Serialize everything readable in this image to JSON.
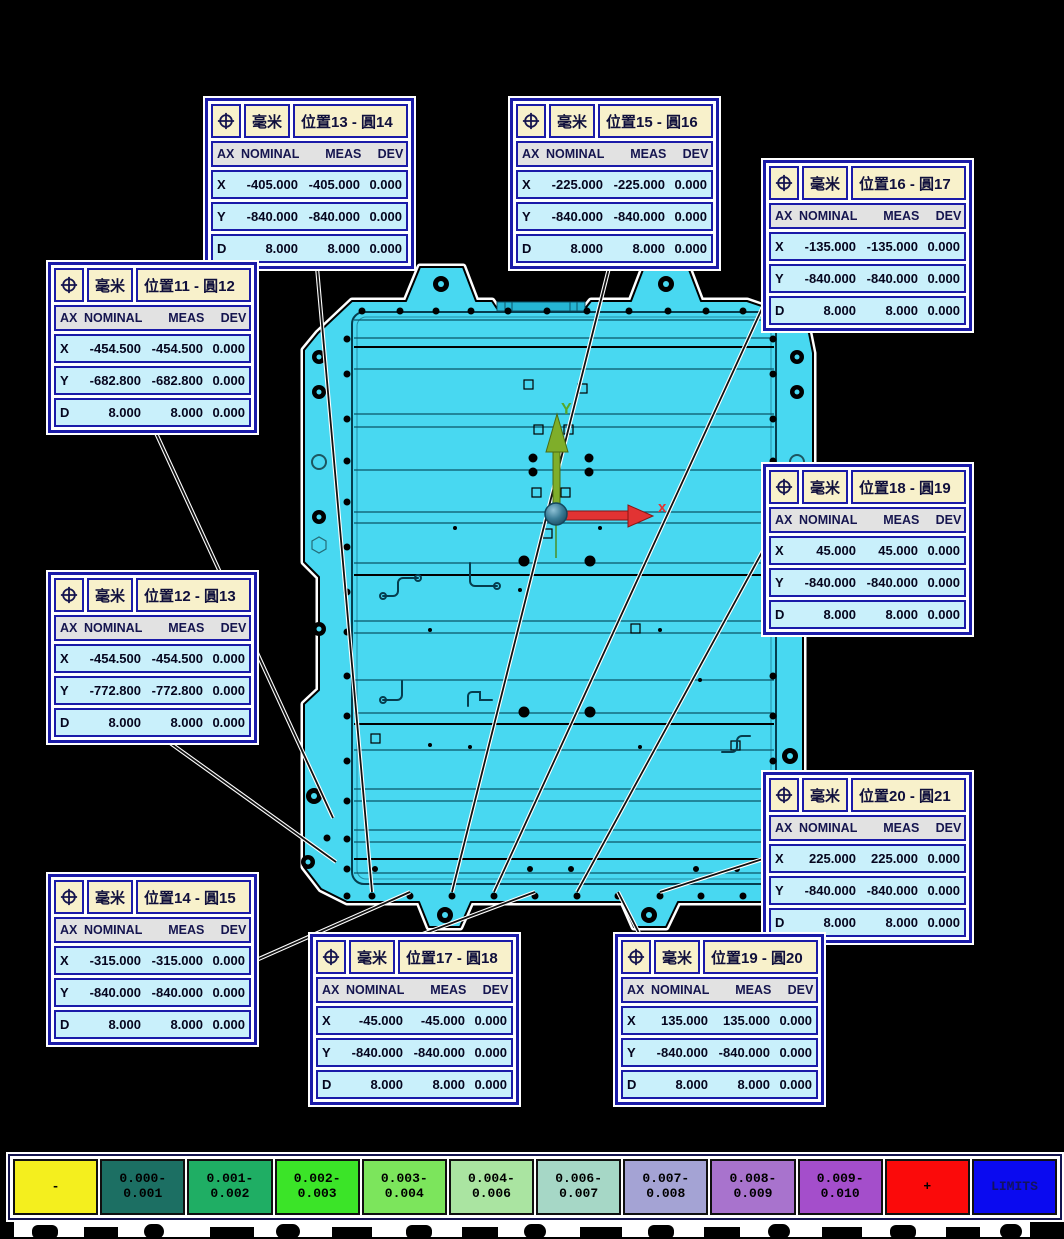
{
  "app": {
    "background": "#000000"
  },
  "colors": {
    "part_fill": "#48D8F1",
    "part_outline": "#000000",
    "box_border": "#1A1AA8",
    "box_header_bg": "#F8F1CB",
    "box_row_bg": "#C9F0FB",
    "axis_x_color": "#E23333",
    "axis_y_color": "#7FAE2A"
  },
  "axes": {
    "x_label": "x",
    "y_label": "Y"
  },
  "boxes": [
    {
      "unit": "毫米",
      "title": "位置13 - 圓14",
      "columns": [
        "AX",
        "NOMINAL",
        "MEAS",
        "DEV"
      ],
      "rows": [
        [
          "X",
          "-405.000",
          "-405.000",
          "0.000"
        ],
        [
          "Y",
          "-840.000",
          "-840.000",
          "0.000"
        ],
        [
          "D",
          "8.000",
          "8.000",
          "0.000"
        ]
      ]
    },
    {
      "unit": "毫米",
      "title": "位置15 - 圓16",
      "columns": [
        "AX",
        "NOMINAL",
        "MEAS",
        "DEV"
      ],
      "rows": [
        [
          "X",
          "-225.000",
          "-225.000",
          "0.000"
        ],
        [
          "Y",
          "-840.000",
          "-840.000",
          "0.000"
        ],
        [
          "D",
          "8.000",
          "8.000",
          "0.000"
        ]
      ]
    },
    {
      "unit": "毫米",
      "title": "位置16 - 圓17",
      "columns": [
        "AX",
        "NOMINAL",
        "MEAS",
        "DEV"
      ],
      "rows": [
        [
          "X",
          "-135.000",
          "-135.000",
          "0.000"
        ],
        [
          "Y",
          "-840.000",
          "-840.000",
          "0.000"
        ],
        [
          "D",
          "8.000",
          "8.000",
          "0.000"
        ]
      ]
    },
    {
      "unit": "毫米",
      "title": "位置11 - 圓12",
      "columns": [
        "AX",
        "NOMINAL",
        "MEAS",
        "DEV"
      ],
      "rows": [
        [
          "X",
          "-454.500",
          "-454.500",
          "0.000"
        ],
        [
          "Y",
          "-682.800",
          "-682.800",
          "0.000"
        ],
        [
          "D",
          "8.000",
          "8.000",
          "0.000"
        ]
      ]
    },
    {
      "unit": "毫米",
      "title": "位置12 - 圓13",
      "columns": [
        "AX",
        "NOMINAL",
        "MEAS",
        "DEV"
      ],
      "rows": [
        [
          "X",
          "-454.500",
          "-454.500",
          "0.000"
        ],
        [
          "Y",
          "-772.800",
          "-772.800",
          "0.000"
        ],
        [
          "D",
          "8.000",
          "8.000",
          "0.000"
        ]
      ]
    },
    {
      "unit": "毫米",
      "title": "位置18 - 圓19",
      "columns": [
        "AX",
        "NOMINAL",
        "MEAS",
        "DEV"
      ],
      "rows": [
        [
          "X",
          "45.000",
          "45.000",
          "0.000"
        ],
        [
          "Y",
          "-840.000",
          "-840.000",
          "0.000"
        ],
        [
          "D",
          "8.000",
          "8.000",
          "0.000"
        ]
      ]
    },
    {
      "unit": "毫米",
      "title": "位置20 - 圓21",
      "columns": [
        "AX",
        "NOMINAL",
        "MEAS",
        "DEV"
      ],
      "rows": [
        [
          "X",
          "225.000",
          "225.000",
          "0.000"
        ],
        [
          "Y",
          "-840.000",
          "-840.000",
          "0.000"
        ],
        [
          "D",
          "8.000",
          "8.000",
          "0.000"
        ]
      ]
    },
    {
      "unit": "毫米",
      "title": "位置14 - 圓15",
      "columns": [
        "AX",
        "NOMINAL",
        "MEAS",
        "DEV"
      ],
      "rows": [
        [
          "X",
          "-315.000",
          "-315.000",
          "0.000"
        ],
        [
          "Y",
          "-840.000",
          "-840.000",
          "0.000"
        ],
        [
          "D",
          "8.000",
          "8.000",
          "0.000"
        ]
      ]
    },
    {
      "unit": "毫米",
      "title": "位置17 - 圓18",
      "columns": [
        "AX",
        "NOMINAL",
        "MEAS",
        "DEV"
      ],
      "rows": [
        [
          "X",
          "-45.000",
          "-45.000",
          "0.000"
        ],
        [
          "Y",
          "-840.000",
          "-840.000",
          "0.000"
        ],
        [
          "D",
          "8.000",
          "8.000",
          "0.000"
        ]
      ]
    },
    {
      "unit": "毫米",
      "title": "位置19 - 圓20",
      "columns": [
        "AX",
        "NOMINAL",
        "MEAS",
        "DEV"
      ],
      "rows": [
        [
          "X",
          "135.000",
          "135.000",
          "0.000"
        ],
        [
          "Y",
          "-840.000",
          "-840.000",
          "0.000"
        ],
        [
          "D",
          "8.000",
          "8.000",
          "0.000"
        ]
      ]
    }
  ],
  "legend": {
    "cells": [
      {
        "line1": "-",
        "line2": "",
        "color": "#F4EF1E",
        "text_color": "#000000"
      },
      {
        "line1": "0.000-",
        "line2": "0.001",
        "color": "#1C6F63",
        "text_color": "#000000"
      },
      {
        "line1": "0.001-",
        "line2": "0.002",
        "color": "#1FAE64",
        "text_color": "#000000"
      },
      {
        "line1": "0.002-",
        "line2": "0.003",
        "color": "#3BE428",
        "text_color": "#000000"
      },
      {
        "line1": "0.003-",
        "line2": "0.004",
        "color": "#7CE55C",
        "text_color": "#000000"
      },
      {
        "line1": "0.004-",
        "line2": "0.006",
        "color": "#AAE4A1",
        "text_color": "#000000"
      },
      {
        "line1": "0.006-",
        "line2": "0.007",
        "color": "#A6D7C6",
        "text_color": "#000000"
      },
      {
        "line1": "0.007-",
        "line2": "0.008",
        "color": "#A4A3D4",
        "text_color": "#000000"
      },
      {
        "line1": "0.008-",
        "line2": "0.009",
        "color": "#A873CD",
        "text_color": "#000000"
      },
      {
        "line1": "0.009-",
        "line2": "0.010",
        "color": "#A44ECB",
        "text_color": "#000000"
      },
      {
        "line1": "+",
        "line2": "",
        "color": "#FB0A0A",
        "text_color": "#000000"
      },
      {
        "line1": "LIMITS",
        "line2": "",
        "color": "#0A0AF0",
        "text_color": "#13135E"
      }
    ]
  }
}
